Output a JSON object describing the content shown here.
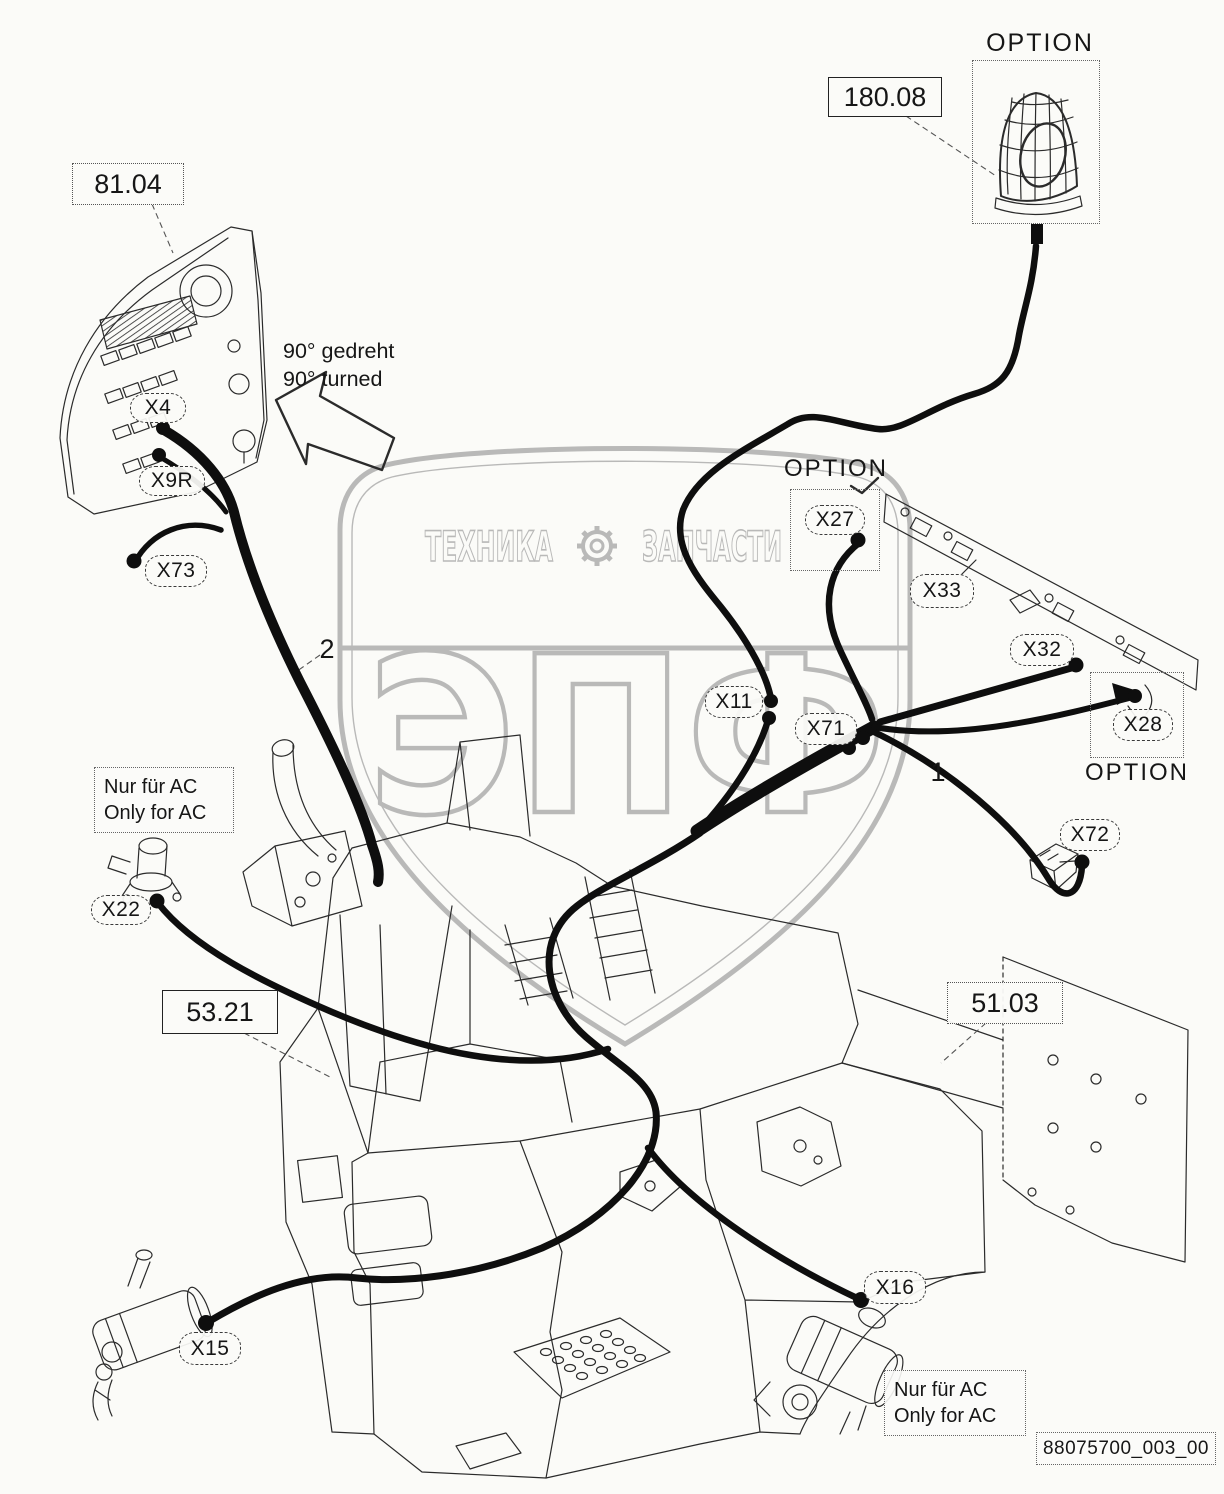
{
  "colors": {
    "background": "#fbfbf8",
    "line": "#2b2b2b",
    "cable": "#0e0e0e",
    "watermark": "#a9a9a9",
    "label_border": "#3a3a3a"
  },
  "ref_labels": [
    {
      "text": "81.04"
    },
    {
      "text": "180.08"
    },
    {
      "text": "53.21"
    },
    {
      "text": "51.03"
    }
  ],
  "doc": {
    "number": "88075700_003_00"
  },
  "connectors": [
    {
      "id": "X4"
    },
    {
      "id": "X9R"
    },
    {
      "id": "X73"
    },
    {
      "id": "X11"
    },
    {
      "id": "X71"
    },
    {
      "id": "X27"
    },
    {
      "id": "X33"
    },
    {
      "id": "X32"
    },
    {
      "id": "X28"
    },
    {
      "id": "X72"
    },
    {
      "id": "X22"
    },
    {
      "id": "X15"
    },
    {
      "id": "X16"
    }
  ],
  "options": {
    "beacon": "OPTION",
    "lights_rail": "OPTION",
    "rear_lamp": "OPTION"
  },
  "callouts": {
    "harness_1": "1",
    "harness_2": "2"
  },
  "notes": {
    "rotated": [
      "90° gedreht",
      "90° turned"
    ],
    "ac_left": [
      "Nur für AC",
      "Only for AC"
    ],
    "ac_right": [
      "Nur für AC",
      "Only for AC"
    ]
  },
  "watermark": {
    "top_left": "ТЕХНИКА",
    "top_right": "ЗАПЧАСТИ",
    "main": "ЭПФ"
  }
}
